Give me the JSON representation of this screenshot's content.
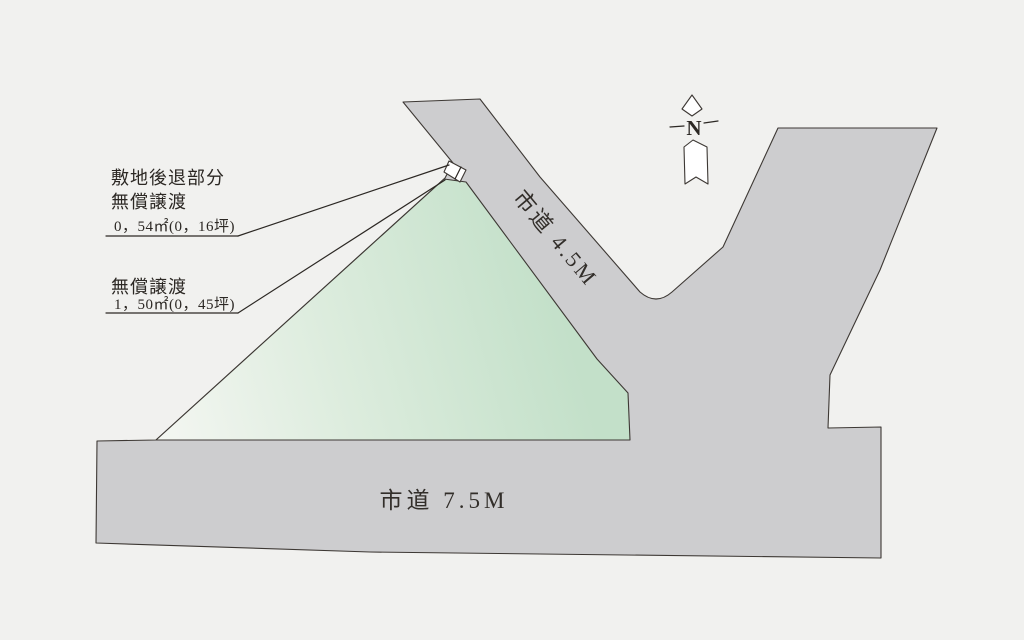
{
  "colors": {
    "background": "#f1f1ef",
    "road": "#cdcdcf",
    "white": "#ffffff",
    "outline": "#3d3834",
    "parcel_gradient": [
      "#f3f6f1",
      "#dcecdd",
      "#c3e0c9"
    ]
  },
  "annotations": {
    "setback": {
      "line1": "敷地後退部分",
      "line2": "無償譲渡",
      "value": "0，54㎡(0，16坪)"
    },
    "transfer": {
      "label": "無償譲渡",
      "value": "1，50㎡(0，45坪)"
    }
  },
  "roads": {
    "diagonal_label": "市道 4.5M",
    "bottom_label": "市道 7.5M"
  },
  "compass": {
    "north_label": "N"
  }
}
